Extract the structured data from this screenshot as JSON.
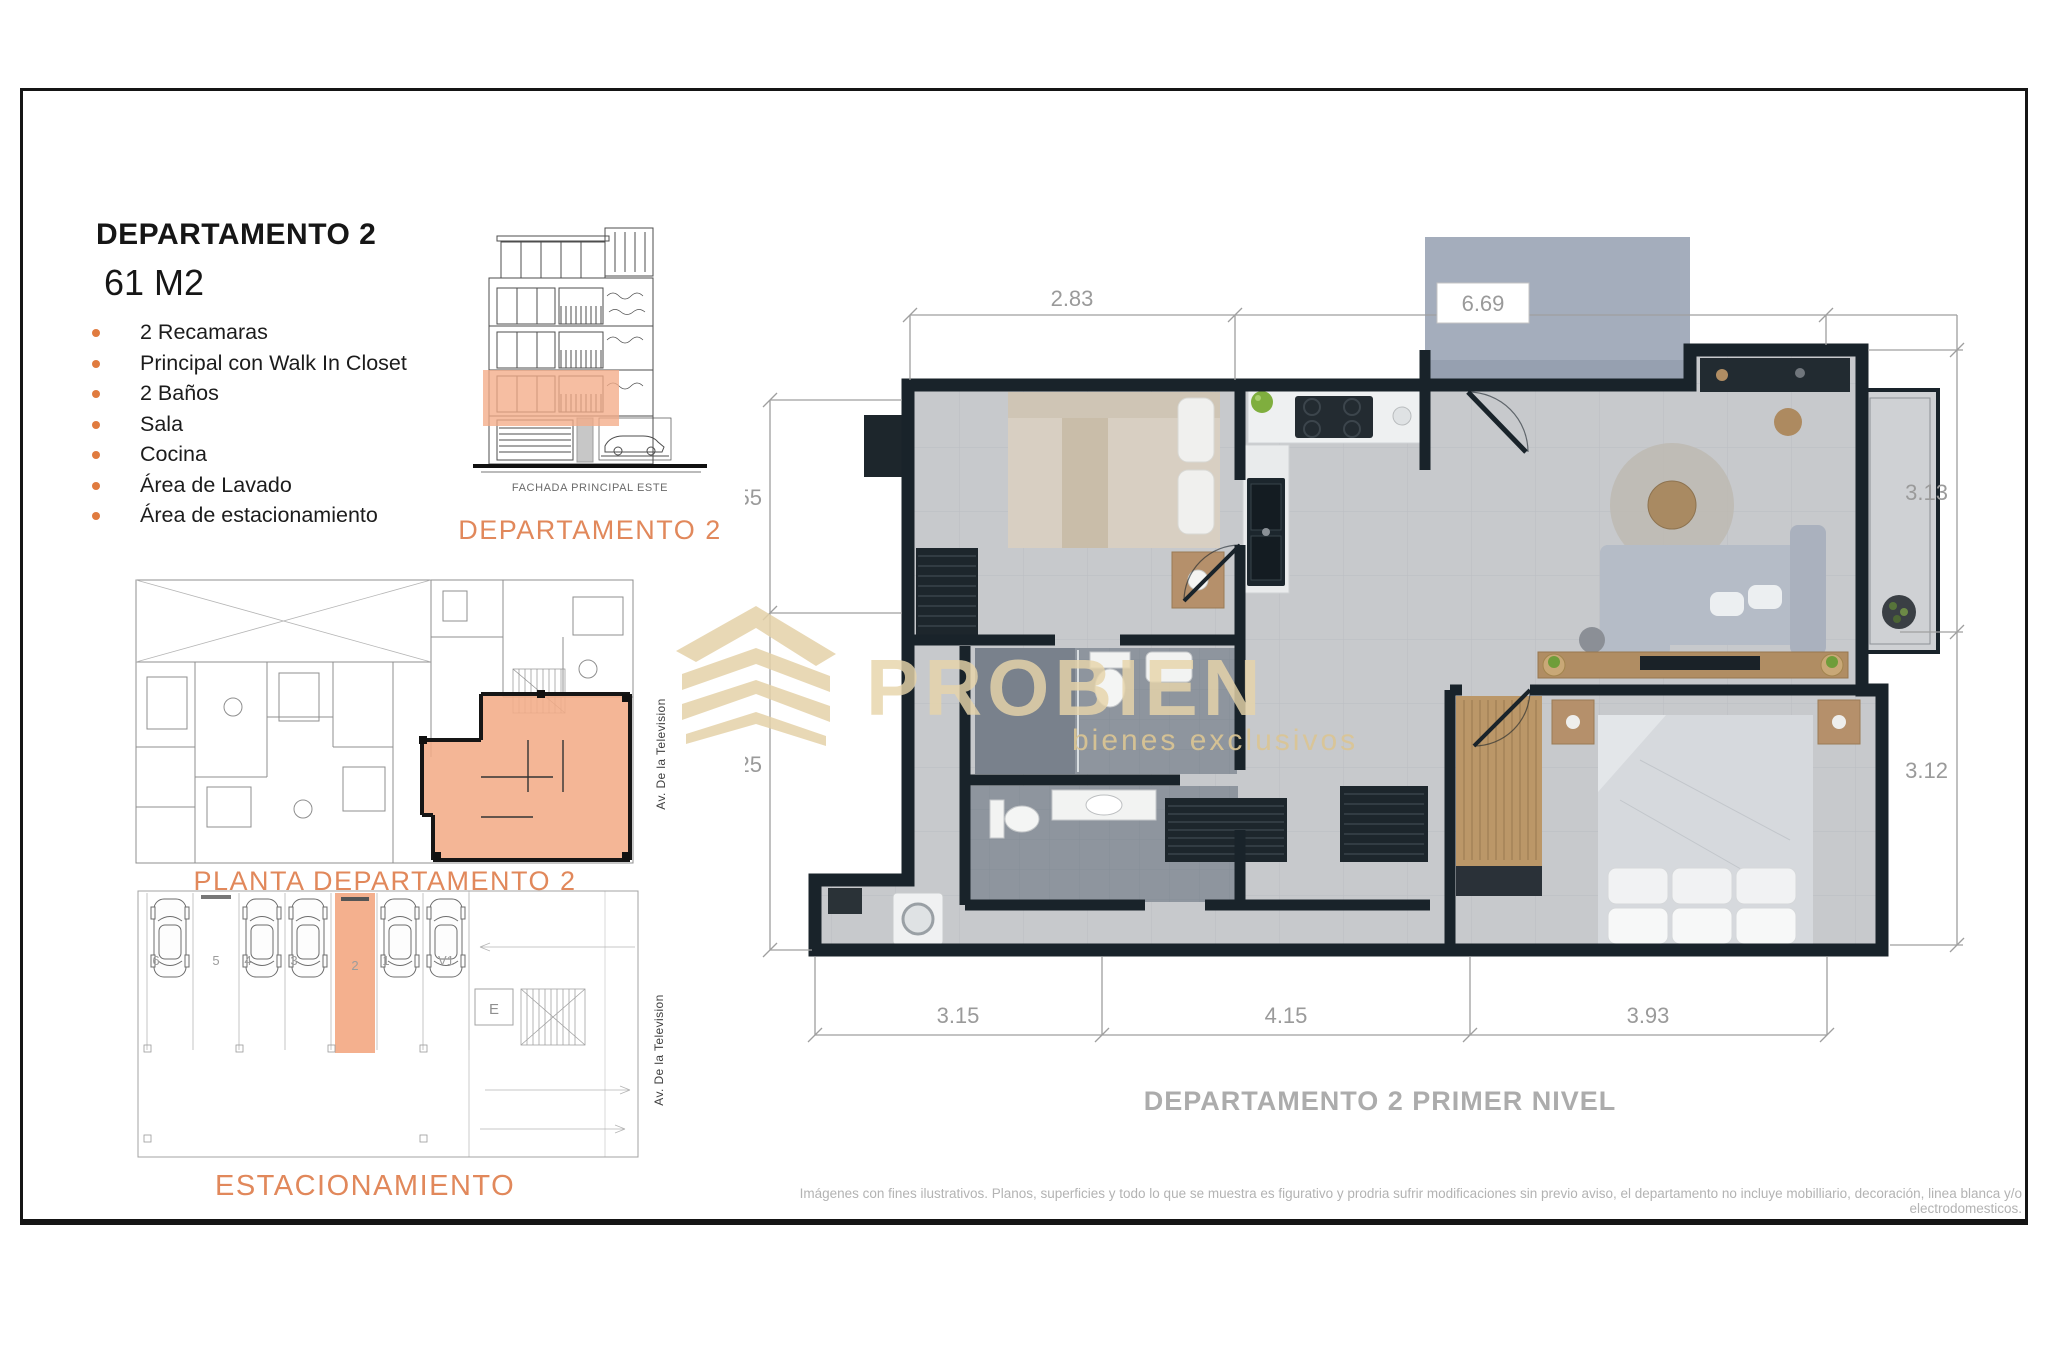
{
  "document": {
    "title": "DEPARTAMENTO 2",
    "area": "61 M2",
    "features": [
      "2 Recamaras",
      "Principal con Walk In Closet",
      "2  Baños",
      "Sala",
      "Cocina",
      "Área de Lavado",
      "Área de estacionamiento"
    ],
    "facade": {
      "drawing_label": "FACHADA PRINCIPAL ESTE",
      "caption": "DEPARTAMENTO 2"
    },
    "floor_plate": {
      "caption": "PLANTA DEPARTAMENTO 2"
    },
    "parking": {
      "caption": "ESTACIONAMIENTO",
      "stall_labels": [
        "6",
        "5",
        "4",
        "3",
        "2",
        "1",
        "V1"
      ],
      "elevator_label": "E"
    },
    "street_labels": {
      "plan": "Av. De la Television",
      "parking": "Av. De la Television"
    },
    "main_plan": {
      "caption": "DEPARTAMENTO 2 PRIMER NIVEL",
      "dims": {
        "top_left": "2.83",
        "top_right": "6.69",
        "left_upper": "2.55",
        "left_lower": "3.25",
        "right_upper": "3.13",
        "right_lower": "3.12",
        "bottom_left": "3.15",
        "bottom_mid": "4.15",
        "bottom_right": "3.93"
      }
    },
    "watermark": {
      "brand": "PROBIEN",
      "tagline": "bienes exclusivos"
    },
    "disclaimer": "Imágenes con fines ilustrativos. Planos, superficies y todo lo que se muestra es figurativo y prodria sufrir modificaciones sin previo aviso, el departamento no incluye mobilliario, decoración, linea blanca y/o electrodomesticos.",
    "colors": {
      "accent": "#e1885b",
      "bullet": "#e07b3f",
      "highlight": "#f3ac88",
      "dim_text": "#9a9a9a",
      "caption_gray": "#acacac",
      "watermark_gold": "#e5d2a9"
    }
  }
}
